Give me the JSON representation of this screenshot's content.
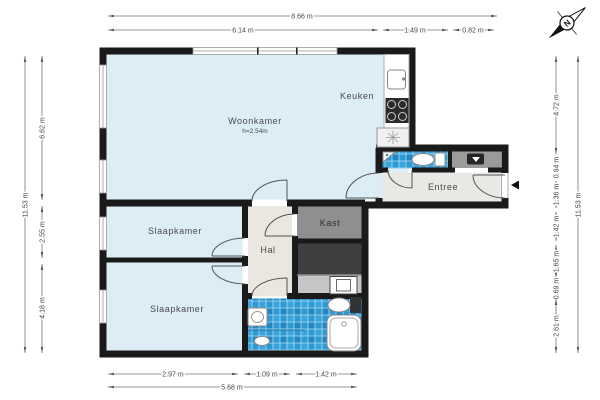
{
  "rooms": {
    "woonkamer": {
      "label": "Woonkamer",
      "sublabel": "h=2.54m"
    },
    "keuken": {
      "label": "Keuken"
    },
    "entree": {
      "label": "Entree"
    },
    "slaapkamer_1": {
      "label": "Slaapkamer"
    },
    "slaapkamer_2": {
      "label": "Slaapkamer"
    },
    "hal": {
      "label": "Hal"
    },
    "kast": {
      "label": "Kast"
    }
  },
  "dimensions": {
    "top_outer": "8.66 m",
    "top_inner": [
      "6.14 m",
      "1.49 m",
      "0.82 m"
    ],
    "bottom_inner": [
      "2.97 m",
      "1.09 m",
      "1.42 m"
    ],
    "bottom_outer": "5.68 m",
    "left_outer": "11.53 m",
    "left_inner": [
      "6.62 m",
      "2.55 m",
      "4.18 m"
    ],
    "right_outer": "11.53 m",
    "right_inner": [
      "4.72 m",
      "0.94 m",
      "1.36 m",
      "1.42 m",
      "1.65 m",
      "0.69 m",
      "2.61 m"
    ]
  },
  "compass": {
    "north_label": "N"
  },
  "colors": {
    "wall": "#1a1a1a",
    "room_floor": "#dcedf6",
    "hall_floor": "#eae7e1",
    "entree_floor": "#e9e8e5",
    "kast_floor": "#8f8f8f",
    "dark_closet_floor": "#3f3f3f",
    "utility_floor": "#c6c6c6",
    "tile_blue": "#2e9ad2",
    "dimension_line": "#777777",
    "dimension_text": "#444444",
    "label_text": "#4a4a4a"
  }
}
